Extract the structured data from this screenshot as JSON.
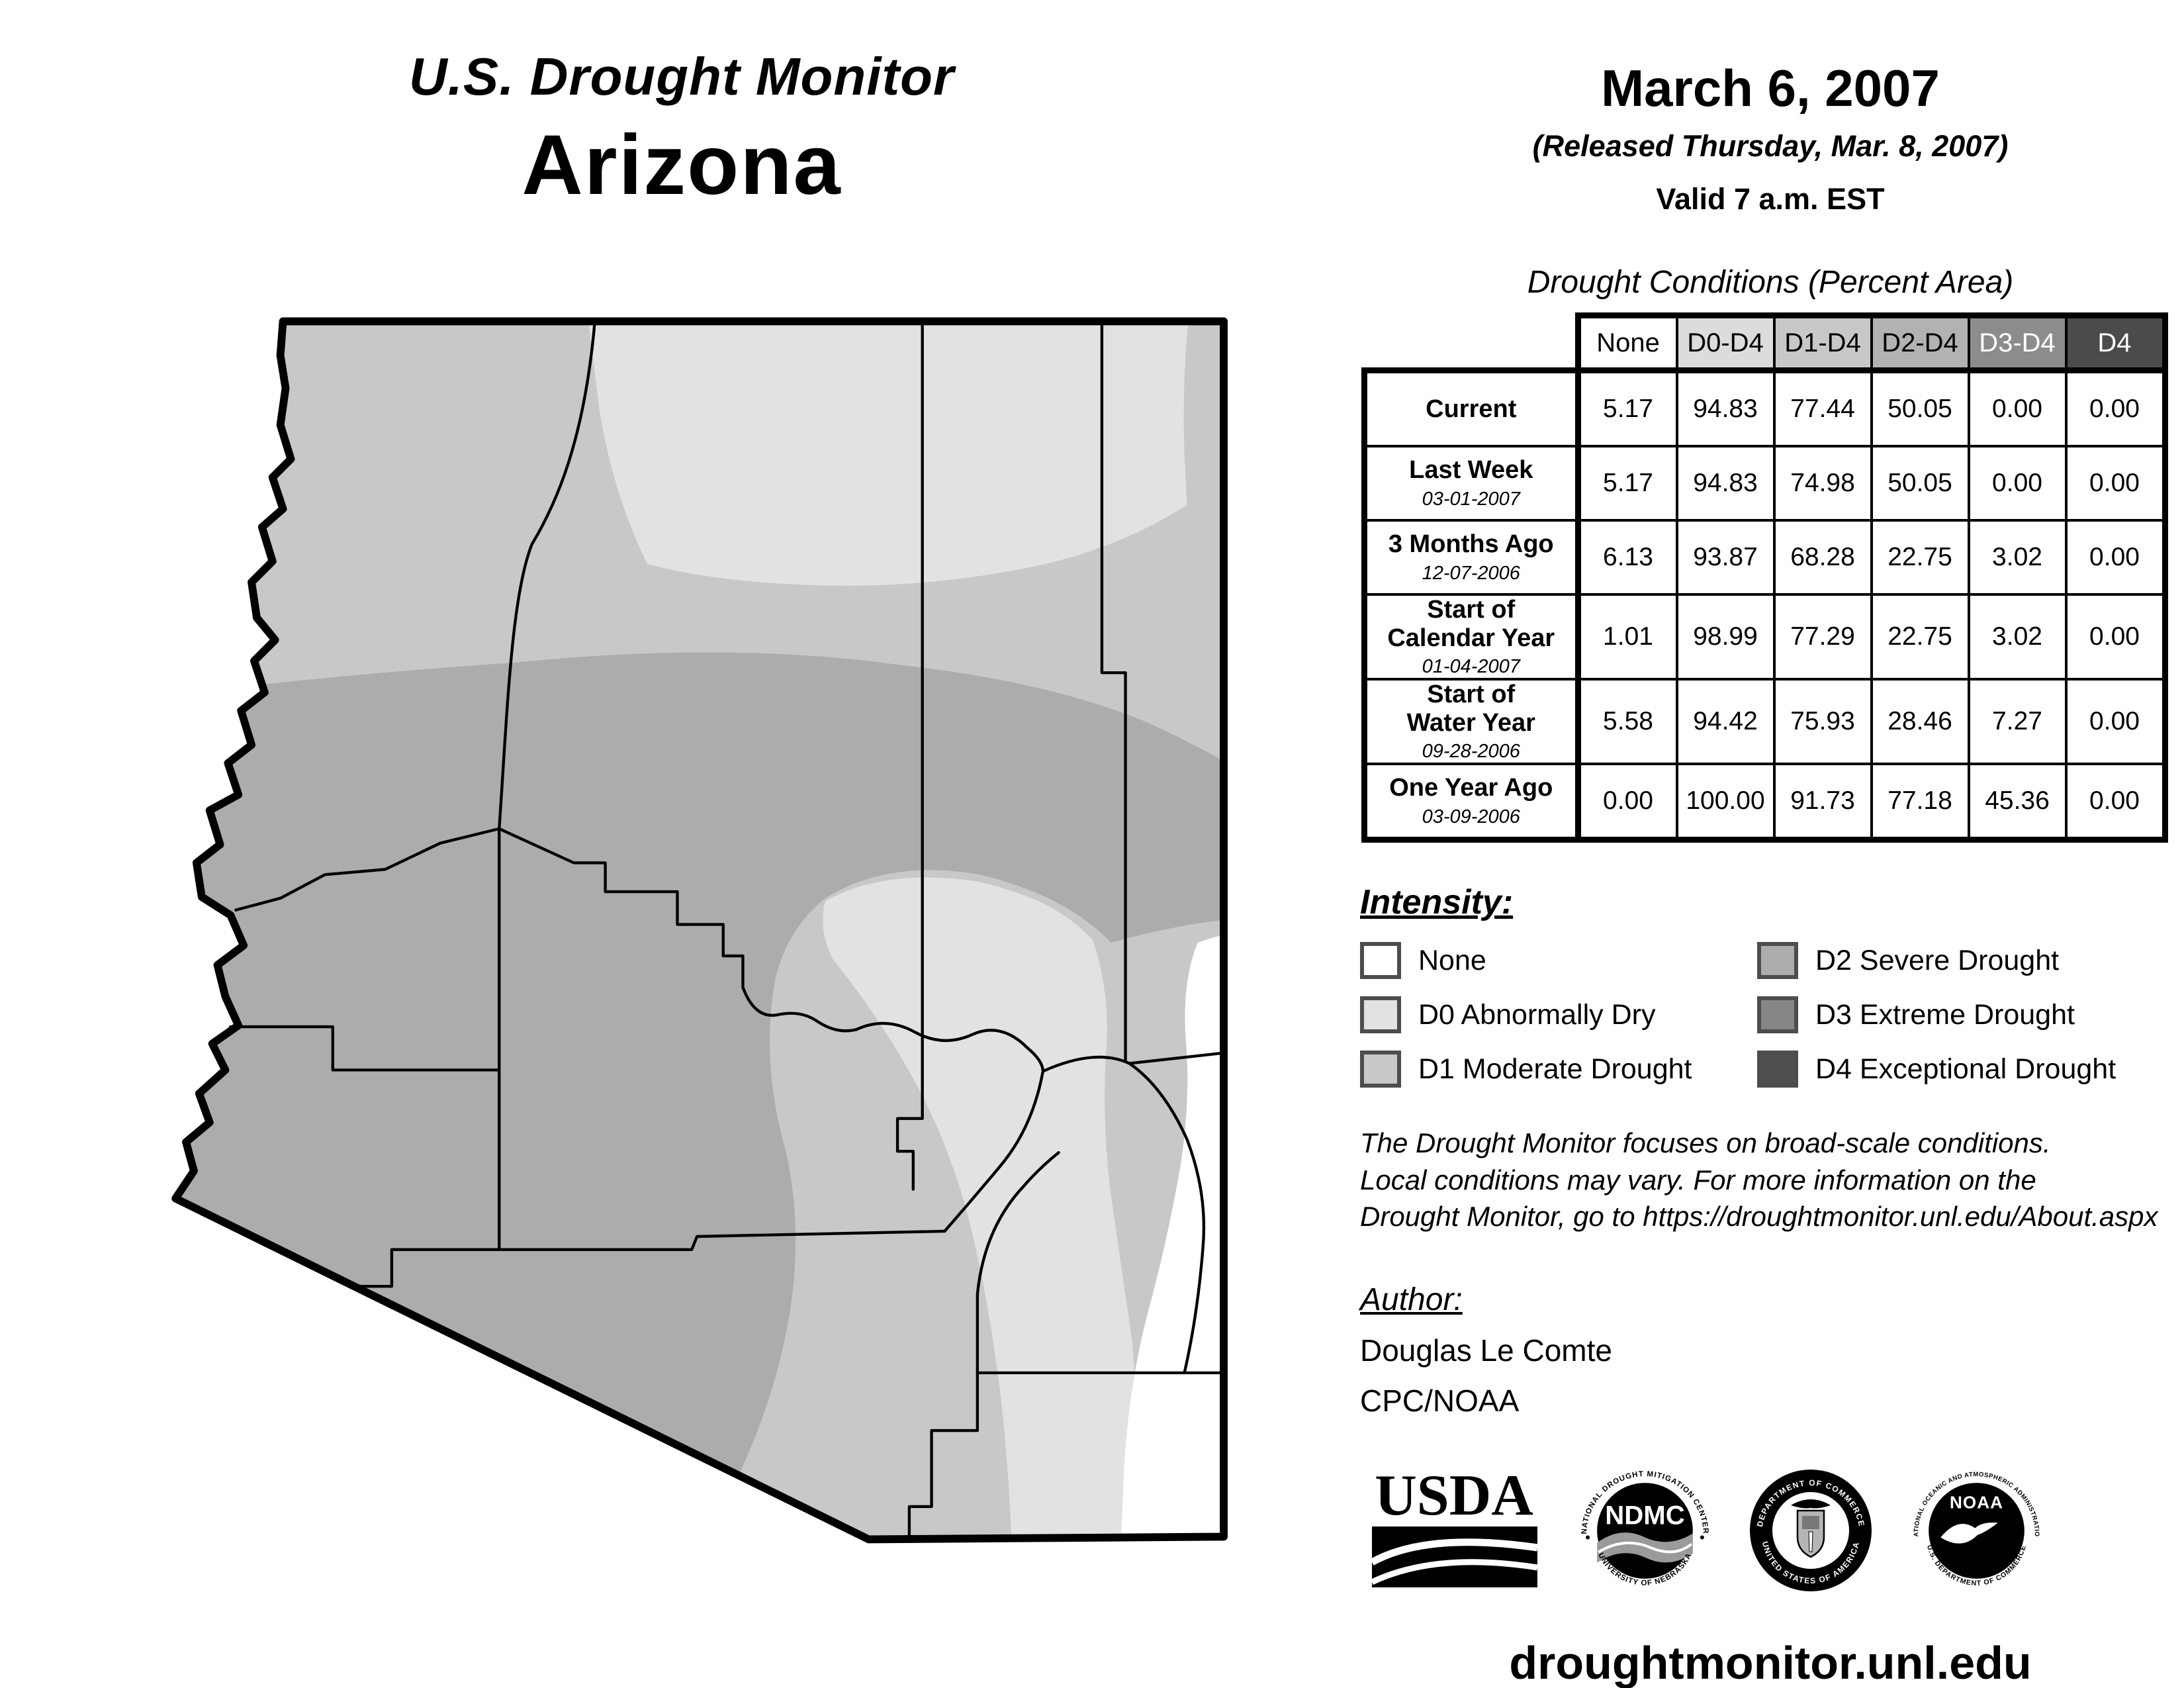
{
  "header": {
    "title": "U.S. Drought Monitor",
    "region": "Arizona",
    "date": "March 6, 2007",
    "released": "(Released Thursday, Mar. 8, 2007)",
    "valid": "Valid 7 a.m. EST"
  },
  "table": {
    "title": "Drought Conditions (Percent Area)",
    "columns": [
      "None",
      "D0-D4",
      "D1-D4",
      "D2-D4",
      "D3-D4",
      "D4"
    ],
    "header_colors": [
      "#ffffff",
      "#dcdcdc",
      "#c8c8c8",
      "#b2b2b2",
      "#8c8c8c",
      "#4b4b4b"
    ],
    "rows": [
      {
        "label1": "Current",
        "label2": "",
        "date": "",
        "values": [
          "5.17",
          "94.83",
          "77.44",
          "50.05",
          "0.00",
          "0.00"
        ]
      },
      {
        "label1": "Last Week",
        "label2": "",
        "date": "03-01-2007",
        "values": [
          "5.17",
          "94.83",
          "74.98",
          "50.05",
          "0.00",
          "0.00"
        ]
      },
      {
        "label1": "3 Months Ago",
        "label2": "",
        "date": "12-07-2006",
        "values": [
          "6.13",
          "93.87",
          "68.28",
          "22.75",
          "3.02",
          "0.00"
        ]
      },
      {
        "label1": "Start of",
        "label2": "Calendar Year",
        "date": "01-04-2007",
        "values": [
          "1.01",
          "98.99",
          "77.29",
          "22.75",
          "3.02",
          "0.00"
        ]
      },
      {
        "label1": "Start of",
        "label2": "Water Year",
        "date": "09-28-2006",
        "values": [
          "5.58",
          "94.42",
          "75.93",
          "28.46",
          "7.27",
          "0.00"
        ]
      },
      {
        "label1": "One Year Ago",
        "label2": "",
        "date": "03-09-2006",
        "values": [
          "0.00",
          "100.00",
          "91.73",
          "77.18",
          "45.36",
          "0.00"
        ]
      }
    ]
  },
  "legend": {
    "title": "Intensity:",
    "items": [
      {
        "label": "None",
        "color": "#ffffff"
      },
      {
        "label": "D0 Abnormally Dry",
        "color": "#e2e2e2"
      },
      {
        "label": "D1 Moderate Drought",
        "color": "#c8c8c8"
      },
      {
        "label": "D2 Severe Drought",
        "color": "#acacac"
      },
      {
        "label": "D3 Extreme Drought",
        "color": "#868686"
      },
      {
        "label": "D4 Exceptional Drought",
        "color": "#4f4f4f"
      }
    ]
  },
  "notes": {
    "line1": "The Drought Monitor focuses on broad-scale conditions.",
    "line2": "Local conditions may vary. For more information on the",
    "line3": "Drought Monitor, go to https://droughtmonitor.unl.edu/About.aspx"
  },
  "author": {
    "heading": "Author:",
    "name": "Douglas Le Comte",
    "org": "CPC/NOAA"
  },
  "logos": {
    "usda": "USDA",
    "ndmc": "NDMC",
    "ndmc_top": "NATIONAL DROUGHT MITIGATION CENTER",
    "ndmc_bottom": "UNIVERSITY OF NEBRASKA",
    "doc_top": "DEPARTMENT OF COMMERCE",
    "doc_bottom": "UNITED STATES OF AMERICA",
    "noaa": "NOAA",
    "noaa_top": "NATIONAL OCEANIC AND ATMOSPHERIC ADMINISTRATION",
    "noaa_bottom": "U.S. DEPARTMENT OF COMMERCE"
  },
  "footer": {
    "url": "droughtmonitor.unl.edu"
  },
  "map": {
    "region": "Arizona",
    "shading": {
      "northwest_strip": "D1",
      "north_center_and_northeast": "D0",
      "central_band_and_west": "D2",
      "south_central": "D1",
      "east_central_band": "D0",
      "southeast_corner": "None"
    },
    "colors": {
      "none": "#ffffff",
      "d0": "#e2e2e2",
      "d1": "#c8c8c8",
      "d2": "#acacac",
      "d3": "#868686",
      "d4": "#4f4f4f"
    }
  }
}
